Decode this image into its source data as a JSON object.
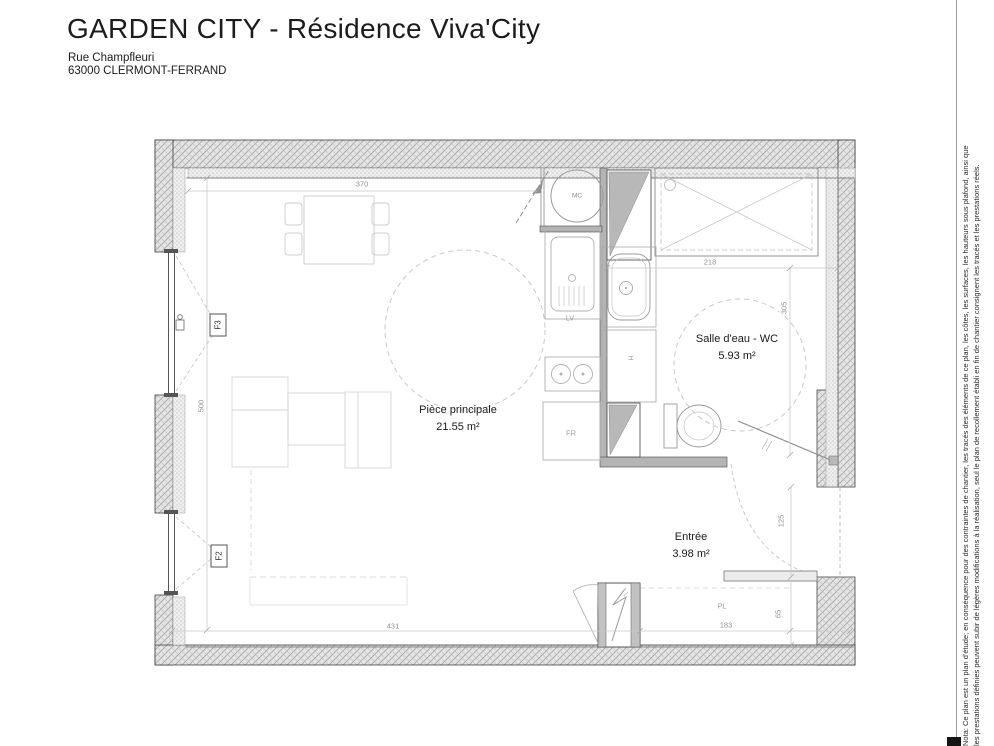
{
  "header": {
    "title": "GARDEN CITY - Résidence Viva'City",
    "address_line1": "Rue Champfleuri",
    "address_line2": "63000 CLERMONT-FERRAND"
  },
  "plan": {
    "rooms": [
      {
        "name": "Pièce principale",
        "area": "21.55 m²"
      },
      {
        "name": "Salle d'eau - WC",
        "area": "5.93 m²"
      },
      {
        "name": "Entrée",
        "area": "3.98 m²"
      }
    ],
    "dimensions": {
      "room_width_top": "370",
      "room_height_left": "500",
      "room_width_bottom": "431",
      "bathroom_width": "218",
      "bathroom_depth": "305",
      "entry_niche": "125",
      "closet_width": "183",
      "closet_depth": "65"
    },
    "fixtures": {
      "window_upper": "F3",
      "window_lower": "F2",
      "sink": "LV",
      "fridge": "FR",
      "water_heater": "MC",
      "closet": "PL",
      "towel_radiator": "H"
    }
  },
  "disclaimer": {
    "line1": "Nota: Ce plan est un plan d'étude; en conséquence pour des contraintes de chantier, les tracés des éléments de ce plan, les côtes, les surfaces, les hauteurs sous plafond, ainsi que",
    "line2": "les prestations définies peuvent subir de légères modifications à la réalisation, seul le plan de recollement établi en fin de chantier consignent les tracés et les prestations réels."
  },
  "colors": {
    "wall_fill": "#e4e4e4",
    "wall_hatch": "#a8a8a8",
    "partition": "#b4b4b4",
    "dim_text": "#8f8f8f",
    "label_text": "#1a1a1a"
  }
}
